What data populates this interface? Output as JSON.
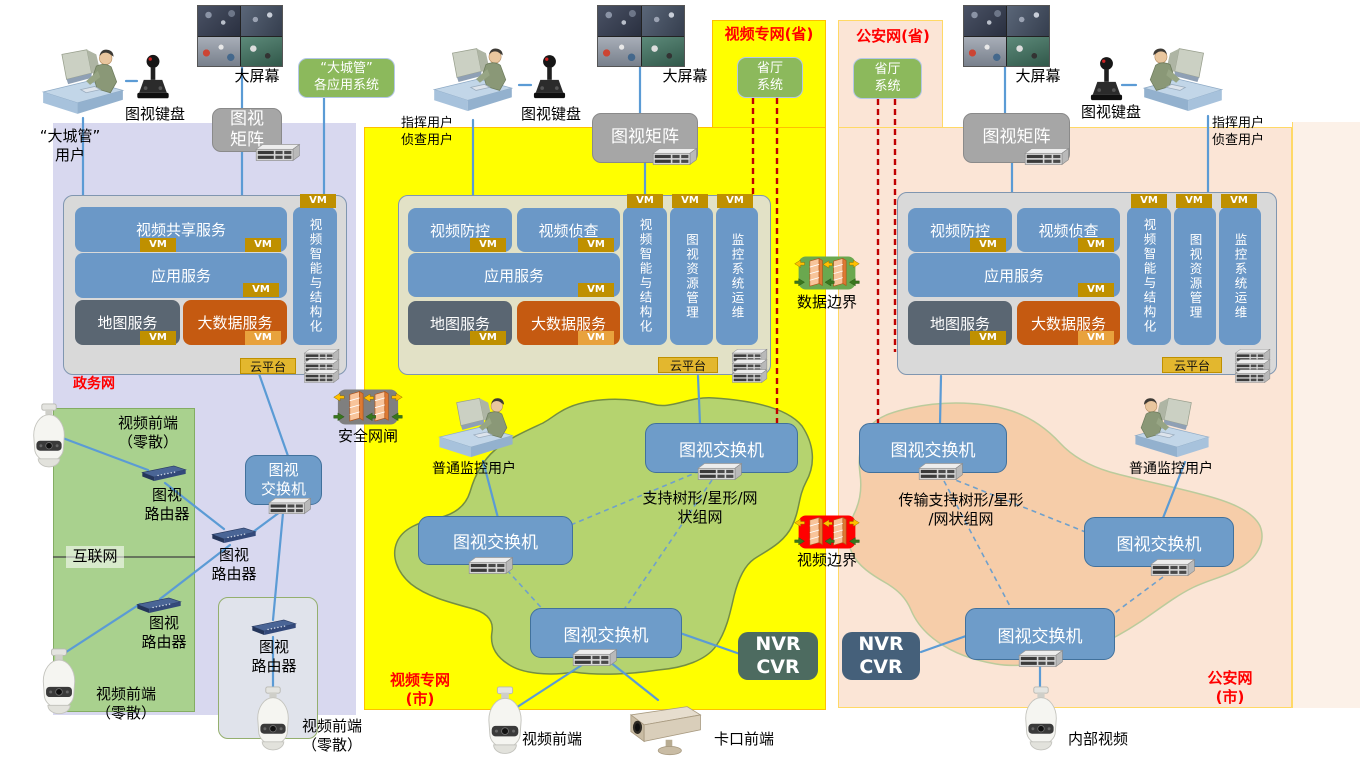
{
  "diagram": {
    "zones": {
      "egov": {
        "title": [
          "电子",
          "政务网"
        ],
        "internet_label": "互联网"
      },
      "video_city": {
        "title": [
          "视频专网",
          "(市)"
        ]
      },
      "video_prov": {
        "title": "视频专网(省)"
      },
      "police_city": {
        "title": [
          "公安网",
          "(市)"
        ]
      },
      "police_prov": {
        "title": "公安网(省)"
      }
    },
    "users": {
      "dcg_user": [
        "“大城管”",
        "用户"
      ],
      "cmd_user": [
        "指挥用户",
        "侦查用户"
      ],
      "normal_user": "普通监控用户"
    },
    "devices": {
      "keyboard": "图视键盘",
      "bigscreen": "大屏幕",
      "matrix": "图视矩阵",
      "matrix2": [
        "图视",
        "矩阵"
      ],
      "switch": "图视交换机",
      "switch2": [
        "图视",
        "交换机"
      ],
      "router": [
        "图视",
        "路由器"
      ],
      "nvr": [
        "NVR",
        "CVR"
      ],
      "video_front": "视频前端",
      "front_scatter": [
        "视频前端",
        "（零散）"
      ],
      "checkpoint_front": "卡口前端",
      "internal_video": "内部视频"
    },
    "systems": {
      "dcg_apps": [
        "“大城管”",
        "各应用系统"
      ],
      "prov_sys": [
        "省厅",
        "系统"
      ]
    },
    "services": {
      "video_share": "视频共享服务",
      "video_def": "视频防控",
      "video_inv": "视频侦查",
      "app": "应用服务",
      "map": "地图服务",
      "bigdata": "大数据服务",
      "ai": "视频智能与结构化",
      "res": "图视资源管理",
      "ops": "监控系统运维",
      "vm": "VM",
      "cloud": "云平台"
    },
    "boundaries": {
      "sec_gate": "安全网闸",
      "data_border": "数据边界",
      "video_border": "视频边界"
    },
    "annotations": {
      "mesh_mid": [
        "支持树形/星形/网",
        "状组网"
      ],
      "mesh_right": [
        "传输支持树形/星形",
        "/网状组网"
      ]
    },
    "colors": {
      "zone_egov": "#D8D8EF",
      "zone_video_city": "#FFFF00",
      "zone_police_city": "#FBE5D6",
      "blob_green": "#B5D36F",
      "blob_orange": "#F6CDA9",
      "service_blue": "#6B98C7",
      "service_dark": "#5A6672",
      "service_orange": "#C55A11",
      "line_blue": "#5B9BD5",
      "line_red": "#C00000",
      "label_red": "#FF0000",
      "vm_gold": "#BF9000"
    }
  }
}
